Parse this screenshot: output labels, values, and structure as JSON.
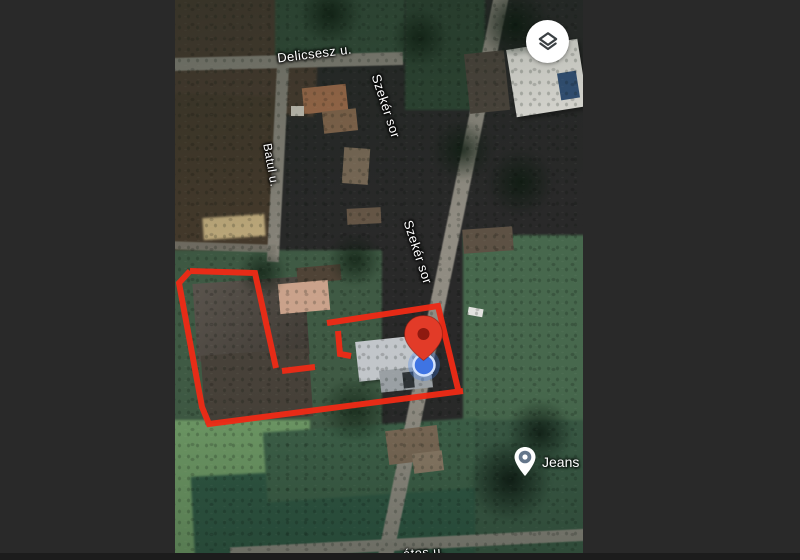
{
  "window": {
    "surround_color": "#292929",
    "bottom_bar_color": "#1c1c1c"
  },
  "map": {
    "view_type": "satellite",
    "street_labels": [
      {
        "text": "Delicsesz u."
      },
      {
        "text": "Szekér sor"
      },
      {
        "text": "Szekér sor"
      },
      {
        "text": "Batul u."
      },
      {
        "text": "átos u."
      }
    ],
    "poi": {
      "label": "Jeans"
    },
    "destination_marker": {
      "pin_color": "#e23b28",
      "pin_inner_color": "#8f1a10"
    },
    "location_dot": {
      "color": "#3f74e3",
      "ring_color": "#d4e2fb",
      "halo_color": "rgba(66,133,244,0.30)"
    },
    "annotation_outline": {
      "color": "#ee2b16"
    },
    "controls": {
      "layers_button": {
        "icon": "layers-icon",
        "background": "#ffffff",
        "glyph_color": "#3b4043"
      }
    }
  }
}
